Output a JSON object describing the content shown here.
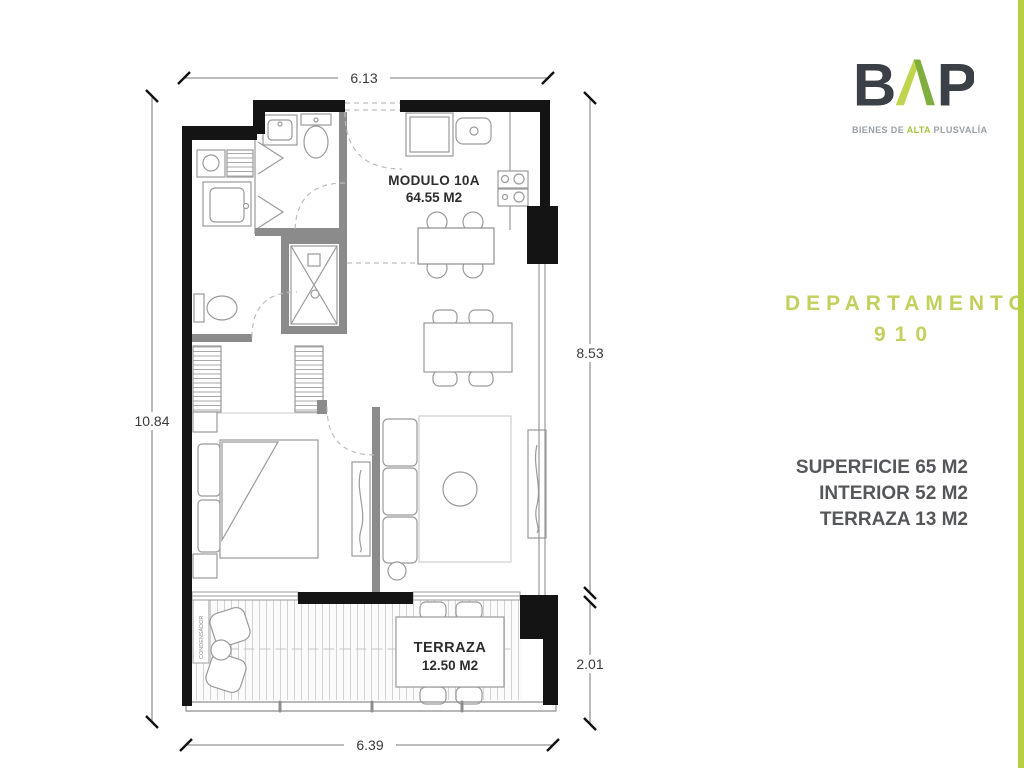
{
  "brand": {
    "letter_b": "B",
    "letter_p": "P",
    "tagline_prefix": "BIENES DE",
    "tagline_highlight": "ALTA",
    "tagline_suffix": "PLUSVALÍA"
  },
  "panel": {
    "title": "DEPARTAMENTO",
    "unit_number": "910",
    "stats": [
      "SUPERFICIE 65 M2",
      "INTERIOR 52 M2",
      "TERRAZA 13 M2"
    ]
  },
  "plan": {
    "module_label": "MODULO 10A",
    "module_area": "64.55 M2",
    "terrace_label": "TERRAZA",
    "terrace_area": "12.50 M2",
    "condenser_label": "CONDENSADOR",
    "dimensions": {
      "top": "6.13",
      "left": "10.84",
      "right_upper": "8.53",
      "right_lower": "2.01",
      "bottom": "6.39"
    }
  },
  "colors": {
    "accent_green": "#b6ce41",
    "accent_green_light": "#c0d44e",
    "accent_green_dark": "#7fae3e",
    "logo_dark": "#3b4047",
    "text_gray": "#55575a",
    "wall_black": "#141414"
  }
}
